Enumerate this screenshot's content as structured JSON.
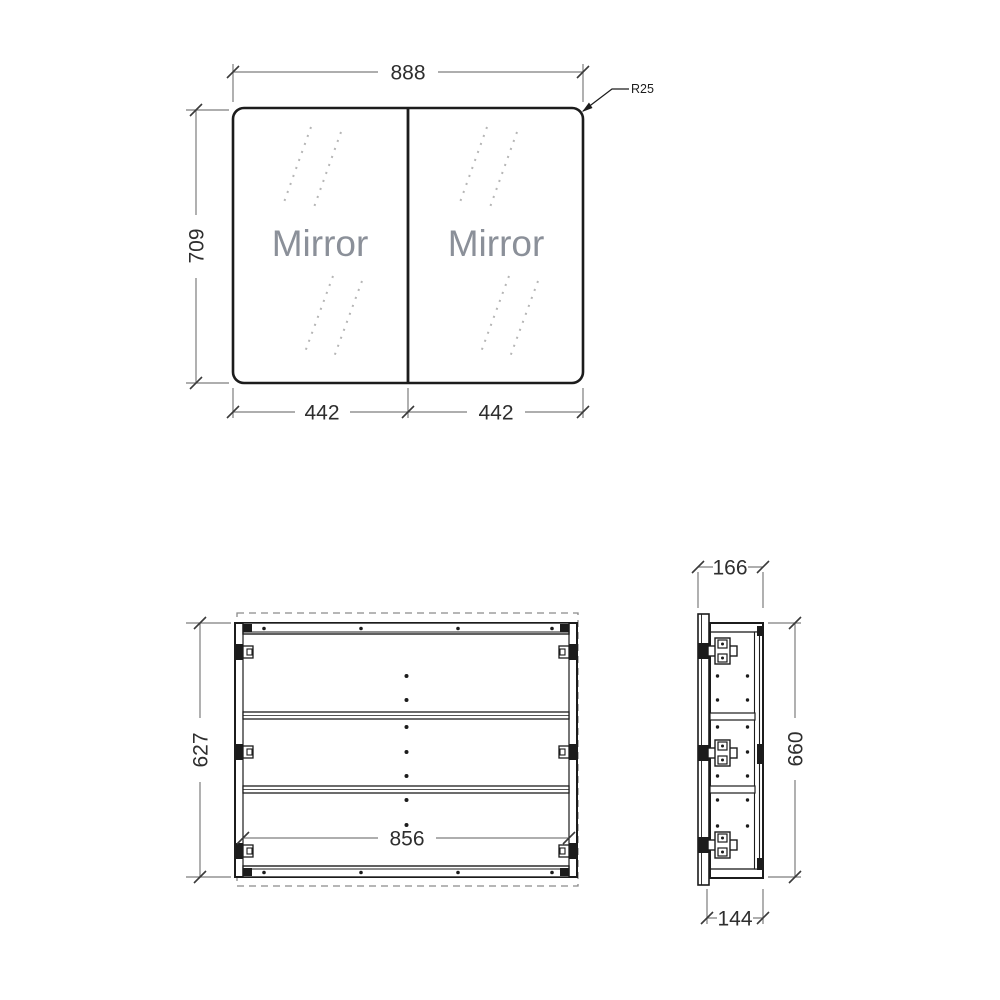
{
  "views": {
    "front": {
      "doors": [
        {
          "label": "Mirror"
        },
        {
          "label": "Mirror"
        }
      ],
      "dims": {
        "width": "888",
        "height": "709",
        "door_left": "442",
        "door_right": "442",
        "corner_radius": "R25"
      }
    },
    "carcass": {
      "dims": {
        "height": "627",
        "inner_width": "856"
      }
    },
    "side": {
      "dims": {
        "depth_total": "166",
        "height": "660",
        "depth_body": "144"
      }
    }
  },
  "colors": {
    "line": "#1c1c1c",
    "dim_line": "#7d7d7d",
    "dim_text": "#2e2e2e",
    "mirror_text": "#8b9099",
    "reflection_dash": "#b5b5b5",
    "background": "#ffffff"
  }
}
